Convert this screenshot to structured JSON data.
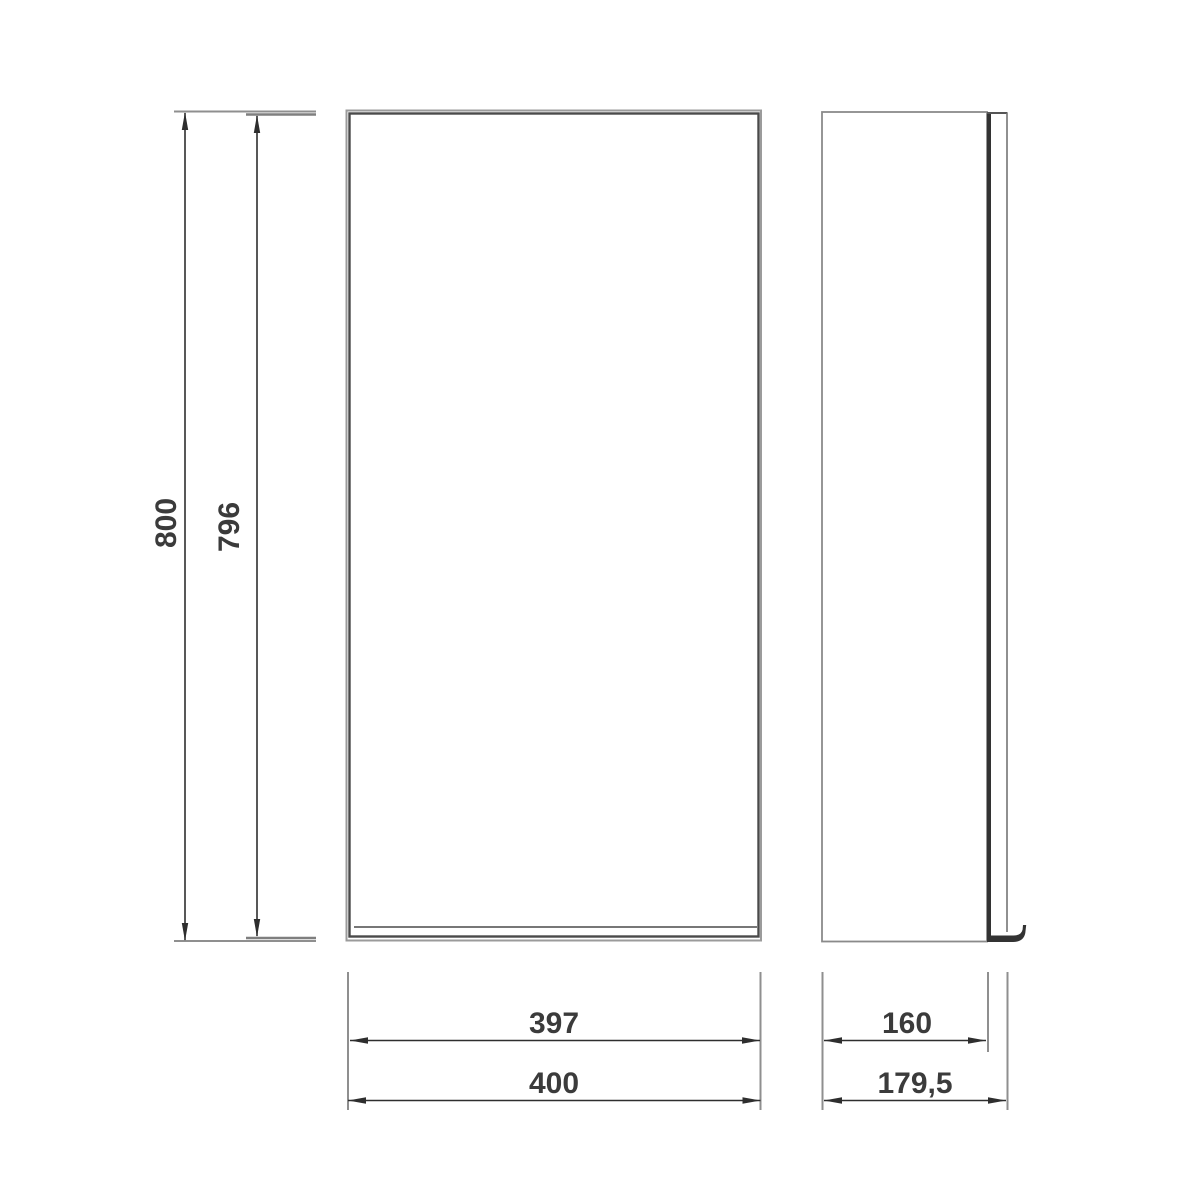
{
  "drawing": {
    "type": "technical-dimension-drawing",
    "subject": "wall cabinet - front and side elevation",
    "units": "mm",
    "colors": {
      "background": "#ffffff",
      "outline_dark": "#4a4a4a",
      "outline_gray": "#8f8f8f",
      "dimension_line": "#2e2e2e",
      "label_text": "#3b3b3b"
    },
    "dimensions": {
      "overall_height": {
        "label": "800",
        "orientation": "vertical",
        "applies_to": "front-view overall height"
      },
      "door_height": {
        "label": "796",
        "orientation": "vertical",
        "applies_to": "front-view door height"
      },
      "door_width": {
        "label": "397",
        "orientation": "horizontal",
        "applies_to": "front-view door width"
      },
      "overall_width": {
        "label": "400",
        "orientation": "horizontal",
        "applies_to": "front-view overall width"
      },
      "body_depth": {
        "label": "160",
        "orientation": "horizontal",
        "applies_to": "side-view body depth"
      },
      "overall_depth": {
        "label": "179,5",
        "orientation": "horizontal",
        "applies_to": "side-view overall depth"
      }
    }
  }
}
